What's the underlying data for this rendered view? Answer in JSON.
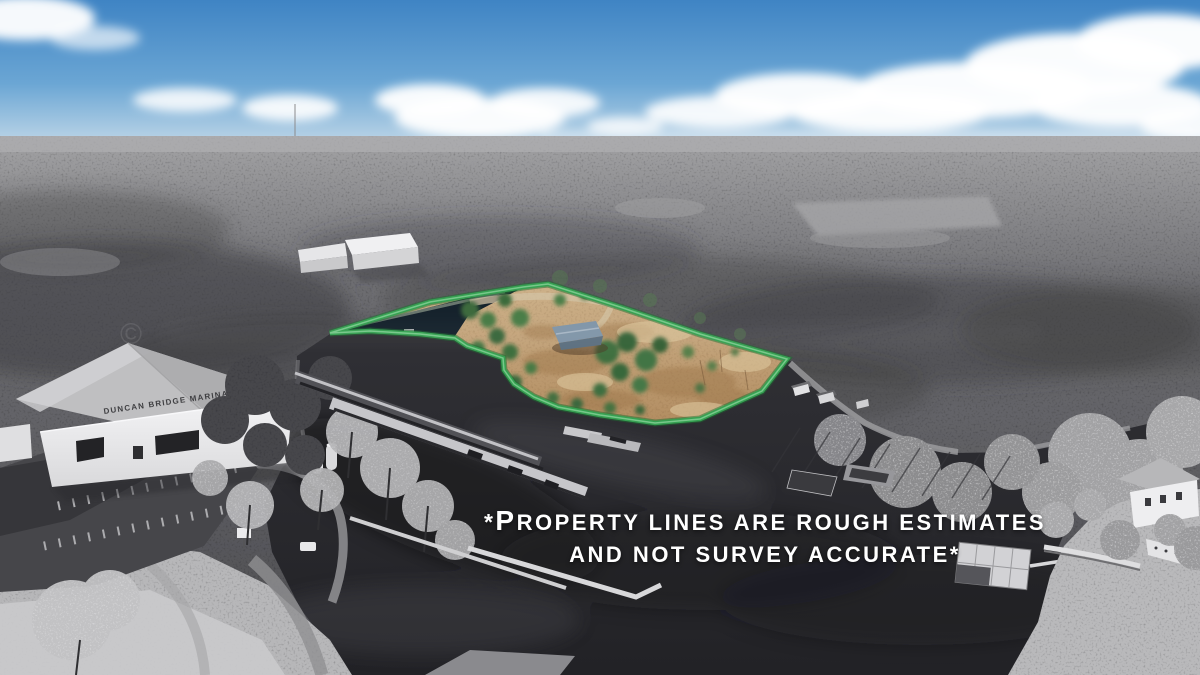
{
  "overlay": {
    "line1_prefix": "*",
    "line1_initial": "P",
    "line1_rest": "ROPERTY LINES ARE ROUGH ESTIMATES",
    "line2": "AND NOT SURVEY ACCURATE*"
  },
  "marina": {
    "sign_text": "DUNCAN BRIDGE MARINA"
  },
  "watermark": {
    "symbol": "©"
  },
  "palette": {
    "boundary_green": "#36a152",
    "sky_top": "#3f84c4",
    "sky_horizon": "#c8dcea",
    "water": "#2b2b2f",
    "parcel_ground": "#c6a97e",
    "overlay_text": "#ffffff"
  }
}
